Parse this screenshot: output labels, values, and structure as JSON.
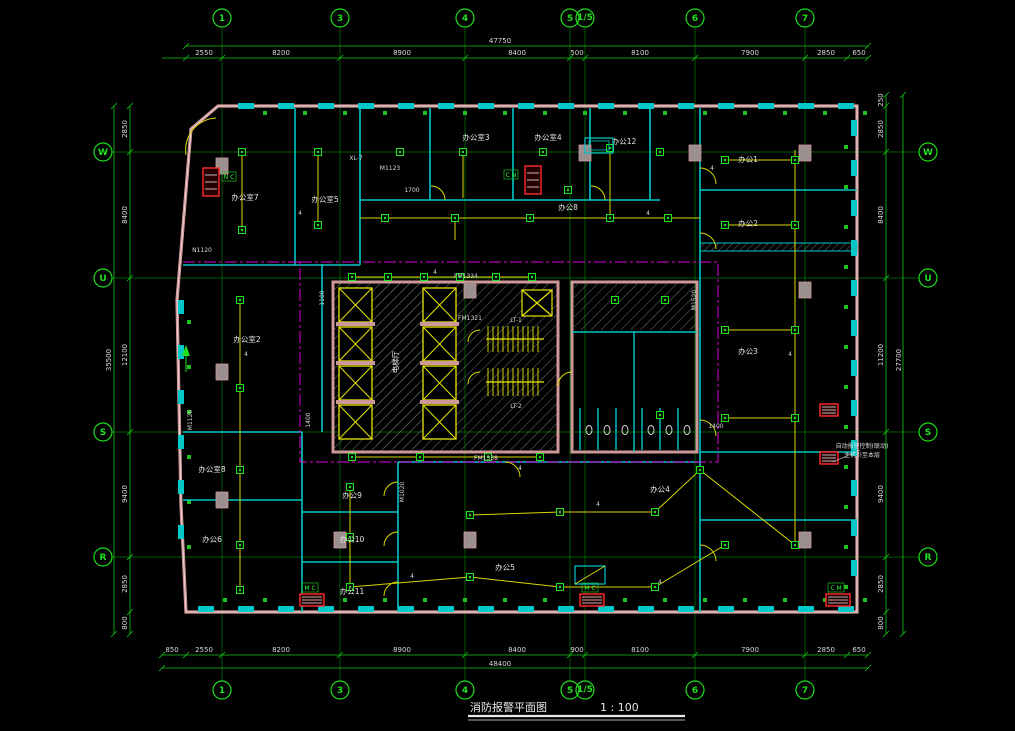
{
  "title": {
    "name": "消防报警平面图",
    "scale": "1 : 100"
  },
  "axes": {
    "top": [
      "1",
      "3",
      "4",
      "5",
      "1/5",
      "6",
      "7"
    ],
    "bottom": [
      "1",
      "3",
      "4",
      "5",
      "1/5",
      "6",
      "7"
    ],
    "left": [
      "W",
      "U",
      "S",
      "R"
    ],
    "right": [
      "W",
      "U",
      "S",
      "R"
    ]
  },
  "dims": {
    "top_overall": "47750",
    "top_segments": [
      "2550",
      "8200",
      "8900",
      "8400",
      "500",
      "8100",
      "7900",
      "2850",
      "650"
    ],
    "bottom_overall": "48400",
    "bottom_segments": [
      "850",
      "2550",
      "8200",
      "8900",
      "8400",
      "900",
      "8100",
      "7900",
      "2850",
      "650"
    ],
    "left_overall": "35500",
    "left_segments": [
      "2850",
      "8400",
      "12100",
      "9400",
      "2850",
      "800"
    ],
    "right_overall": "27700",
    "right_segments": [
      "250",
      "2850",
      "8400",
      "11200",
      "9400",
      "2850",
      "800"
    ]
  },
  "rooms": [
    {
      "label": "办公室7"
    },
    {
      "label": "办公室5"
    },
    {
      "label": "办公室3"
    },
    {
      "label": "办公室4"
    },
    {
      "label": "办公12"
    },
    {
      "label": "办公8"
    },
    {
      "label": "办公室2"
    },
    {
      "label": "办公室8"
    },
    {
      "label": "办公6"
    },
    {
      "label": "办公1"
    },
    {
      "label": "办公2"
    },
    {
      "label": "办公3"
    },
    {
      "label": "办公9"
    },
    {
      "label": "办公10"
    },
    {
      "label": "办公11"
    },
    {
      "label": "办公5"
    },
    {
      "label": "办公4"
    },
    {
      "label": "电梯厅"
    }
  ],
  "stairs": {
    "s1": "LT-1",
    "s2": "LT-2"
  },
  "tags": {
    "xl": "XL-7",
    "fm1": "FM1334",
    "fm2": "FM1321",
    "fm3": "FM1338",
    "m1": "M1020",
    "m2": "M1123",
    "m3": "M1120",
    "m4": "M1520",
    "m5": "N1120",
    "d1": "1700",
    "d2": "1400",
    "d3": "1100",
    "d4": "1400",
    "wire": "4"
  },
  "equipment": {
    "mc": "M C",
    "cn": "C N",
    "cm": "C M",
    "nc": "N C"
  },
  "annotation": {
    "line1": "自动报警控制(联动)",
    "line2": "主机引至本层"
  },
  "colors": {
    "grid": "#00b400",
    "cyan": "#00d2d2",
    "yellow": "#e6e600",
    "magenta": "#dd00dd",
    "pink": "#cf9898",
    "red": "#ff2a2a",
    "white": "#e0e0e0"
  }
}
